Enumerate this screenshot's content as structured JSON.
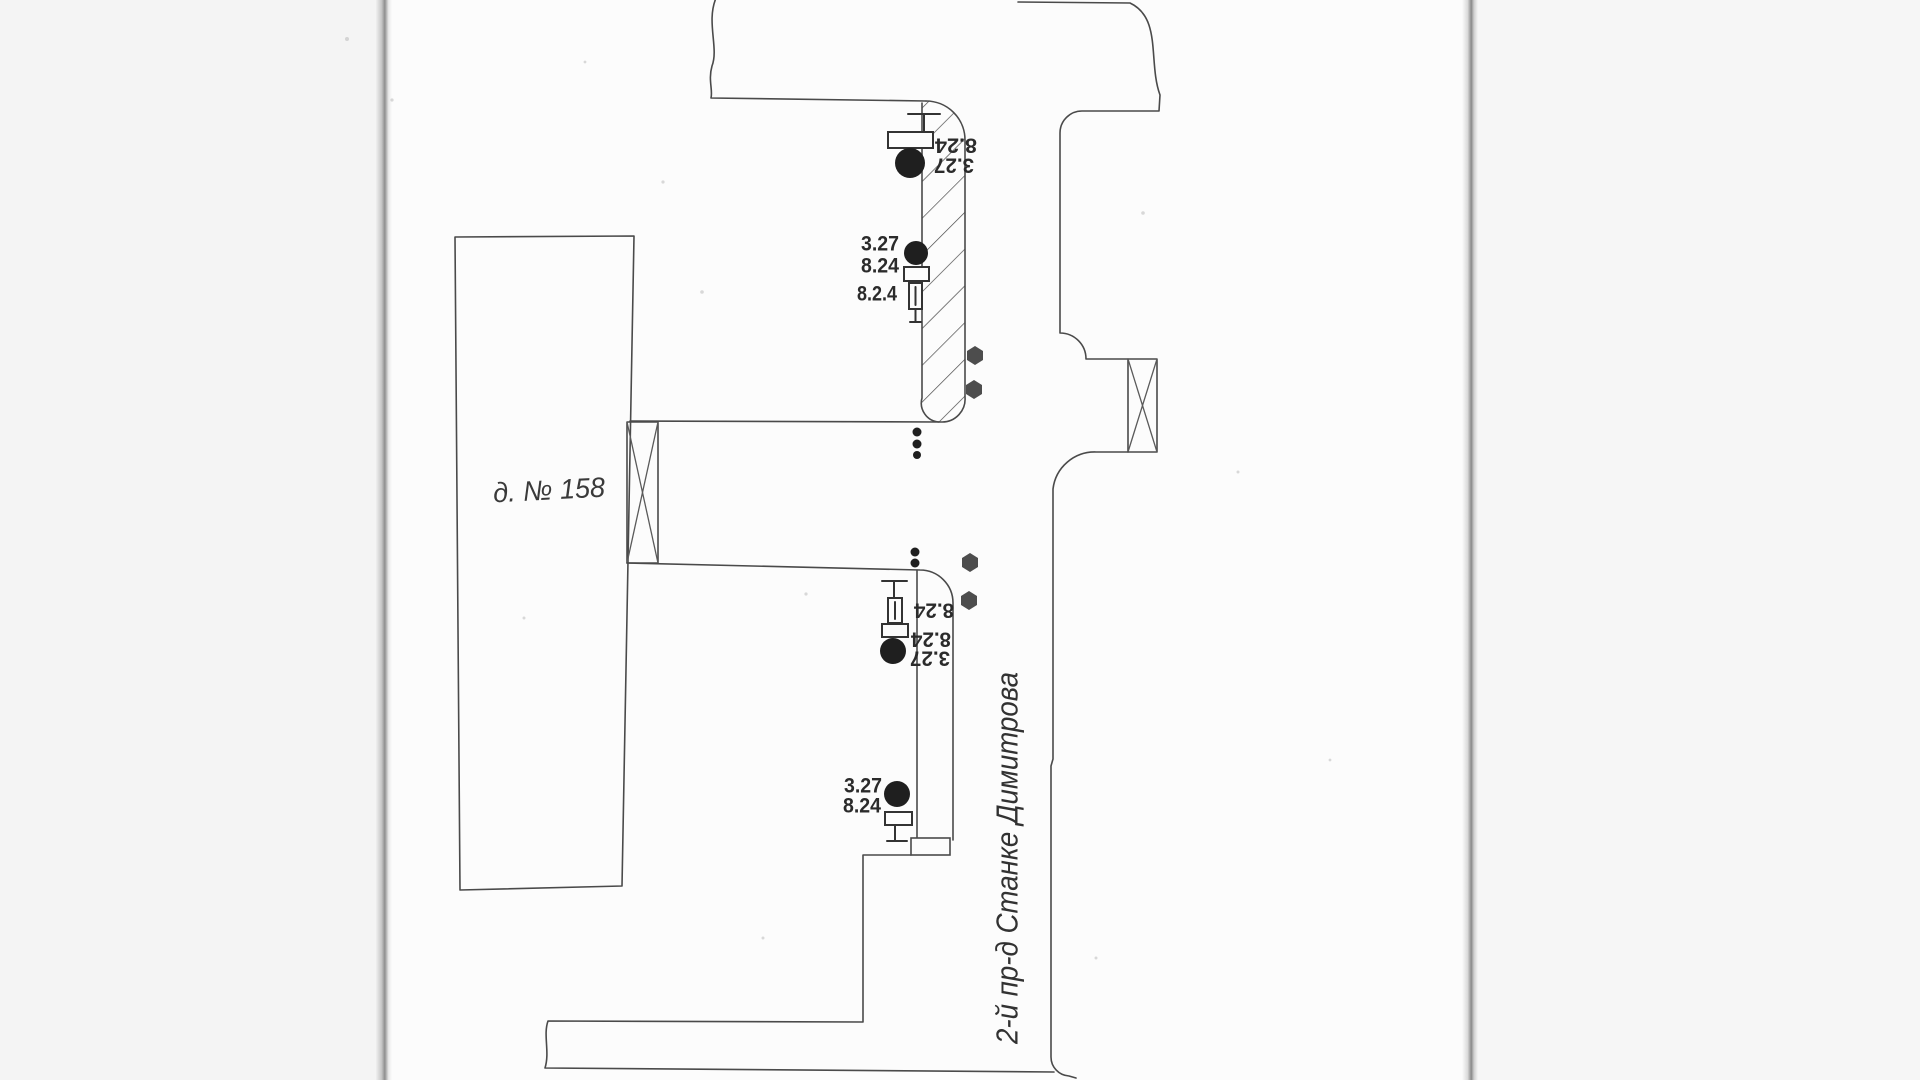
{
  "page": {
    "background": "#fcfcfc",
    "margin_color": "#f4f4f4",
    "ink_color": "#4a4a4a",
    "type_note": "scanned site plan sheet"
  },
  "building": {
    "label": "д. № 158"
  },
  "street": {
    "label": "2-й пр-д Станке Димитрова"
  },
  "markers": {
    "top_group": {
      "rect_value": "8.24",
      "circle_value": "3.27"
    },
    "mid_group": {
      "circle_value": "3.27",
      "rect_value": "8.24",
      "hydrant_value": "8.2.4"
    },
    "low_group": {
      "hydrant_value": "8.24",
      "rect_value": "8.24",
      "circle_value": "3.27"
    },
    "bottom_group": {
      "circle_value": "3.27",
      "rect_value": "8.24"
    }
  }
}
